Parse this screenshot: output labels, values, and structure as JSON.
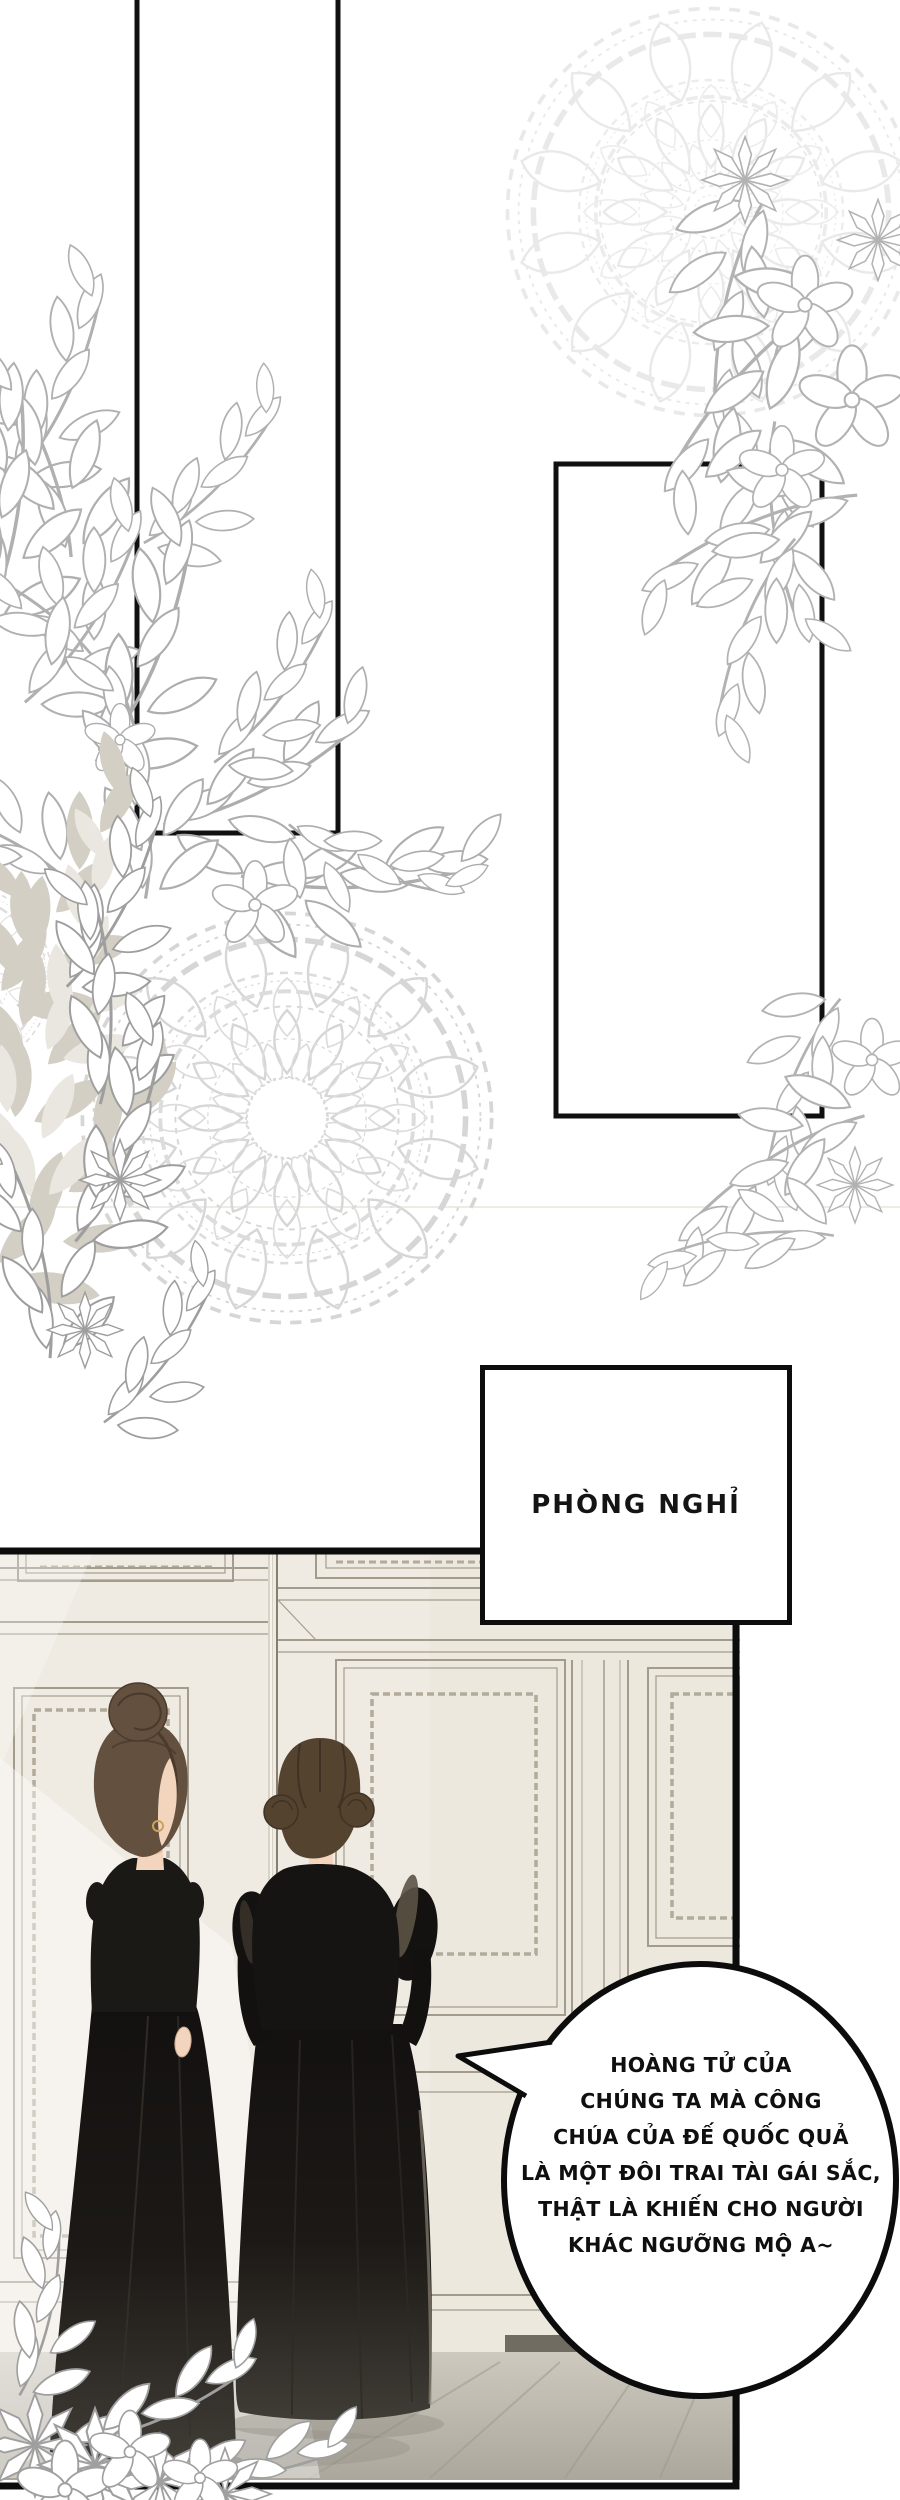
{
  "page": {
    "width_px": 900,
    "height_px": 2500,
    "background": "#ffffff"
  },
  "panel_label": {
    "text": "PHÒNG NGHỈ"
  },
  "speech_bubble": {
    "shape": "ellipse",
    "tail_direction": "left",
    "lines": [
      "HOÀNG TỬ CỦA",
      "CHÚNG TA MÀ CÔNG",
      "CHÚA CỦA ĐẾ QUỐC QUẢ",
      "LÀ MỘT ĐÔI TRAI TÀI GÁI SẮC,",
      "THẬT LÀ KHIẾN CHO NGƯỜI",
      "KHÁC NGƯỠNG MỘ A~"
    ]
  },
  "colors": {
    "ink": "#0d0d0d",
    "paper": "#ffffff",
    "lace_light": "#e8e8e8",
    "doily": "#d7d7d7",
    "foliage_outline": "#adadad",
    "foliage_gray_fill": "#cfcbc0",
    "wall_cream": "#efebe2",
    "door_panel": "#ebe6da",
    "molding": "#a39c8d",
    "rope_trim": "#b2aa9a",
    "dress_dark": "#161412",
    "dress_hem": "#3d3933",
    "hair_left_maid": "#63503f",
    "hair_right_maid": "#54432f",
    "skin": "#f2d5bc",
    "floor": "#c7c3b8",
    "baseboard": "#716c62",
    "earring_gold": "#c9a25c"
  }
}
